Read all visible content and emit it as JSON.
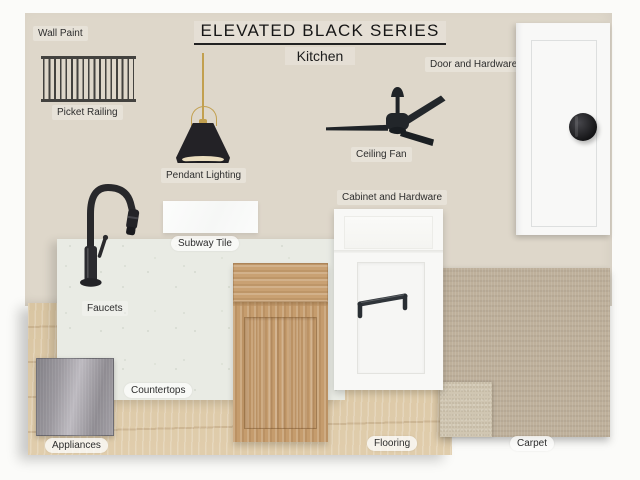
{
  "board": {
    "title": "ELEVATED BLACK SERIES",
    "subtitle": "Kitchen"
  },
  "labels": {
    "wall_paint": "Wall Paint",
    "picket_railing": "Picket Railing",
    "pendant_lighting": "Pendant Lighting",
    "ceiling_fan": "Ceiling Fan",
    "door_and_hardware": "Door and Hardware",
    "subway_tile": "Subway Tile",
    "cabinet_and_hardware": "Cabinet and Hardware",
    "faucets": "Faucets",
    "countertops": "Countertops",
    "appliances": "Appliances",
    "flooring": "Flooring",
    "carpet": "Carpet"
  },
  "palette": {
    "wall_paint": "#DED7CA",
    "page_background": "#FBFBF9",
    "countertop": "#E9EBE4",
    "cabinet_wood": "#C59C6D",
    "flooring_wood": "#DBC7A5",
    "carpet": "#BEB09B",
    "carpet_swatch_small": "#D0C6B2",
    "stainless_steel": "#A9A6AC",
    "matte_black_fixtures": "#222326",
    "brass": "#C2A04F",
    "door_white": "#F8F8F7",
    "cabinet_white": "#F8F8F6",
    "subway_tile_white": "#FAFBFA"
  }
}
